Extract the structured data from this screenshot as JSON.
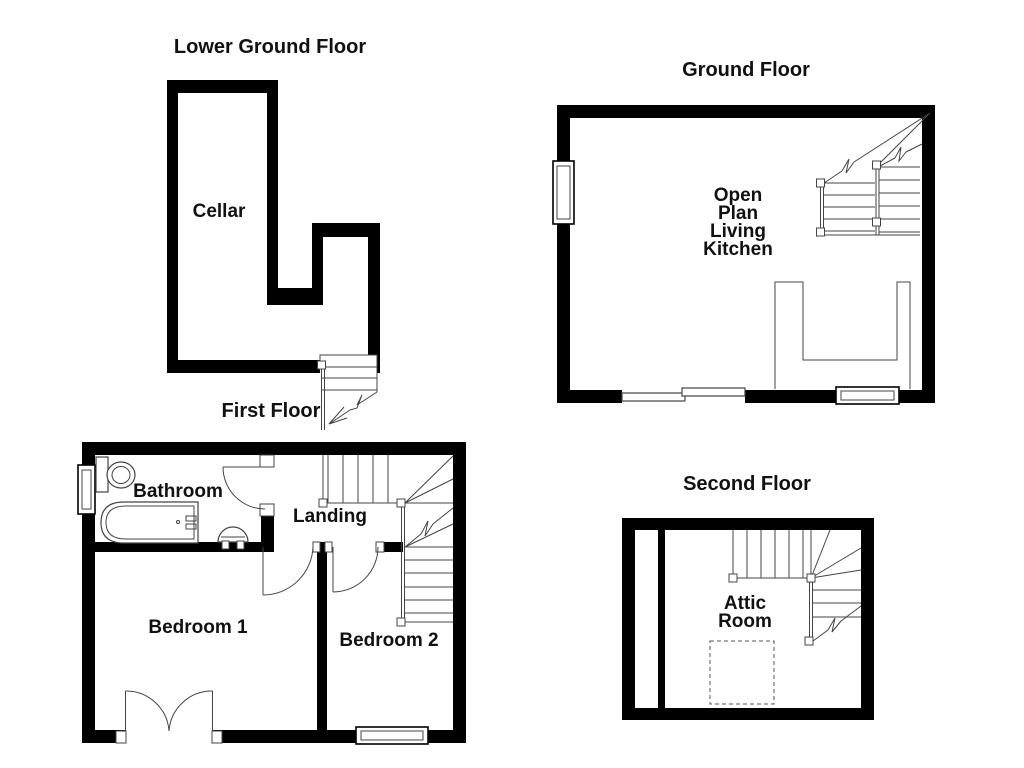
{
  "colors": {
    "wall": "#000000",
    "thin_line": "#444444",
    "text": "#111111",
    "background": "#ffffff"
  },
  "lower_ground": {
    "title": "Lower Ground Floor",
    "cellar_label": "Cellar"
  },
  "ground": {
    "title": "Ground Floor",
    "open_plan_lines": [
      "Open",
      "Plan",
      "Living",
      "Kitchen"
    ]
  },
  "first": {
    "title": "First Floor",
    "bathroom_label": "Bathroom",
    "landing_label": "Landing",
    "bedroom1_label": "Bedroom 1",
    "bedroom2_label": "Bedroom 2"
  },
  "second": {
    "title": "Second Floor",
    "attic_lines": [
      "Attic",
      "Room"
    ]
  }
}
